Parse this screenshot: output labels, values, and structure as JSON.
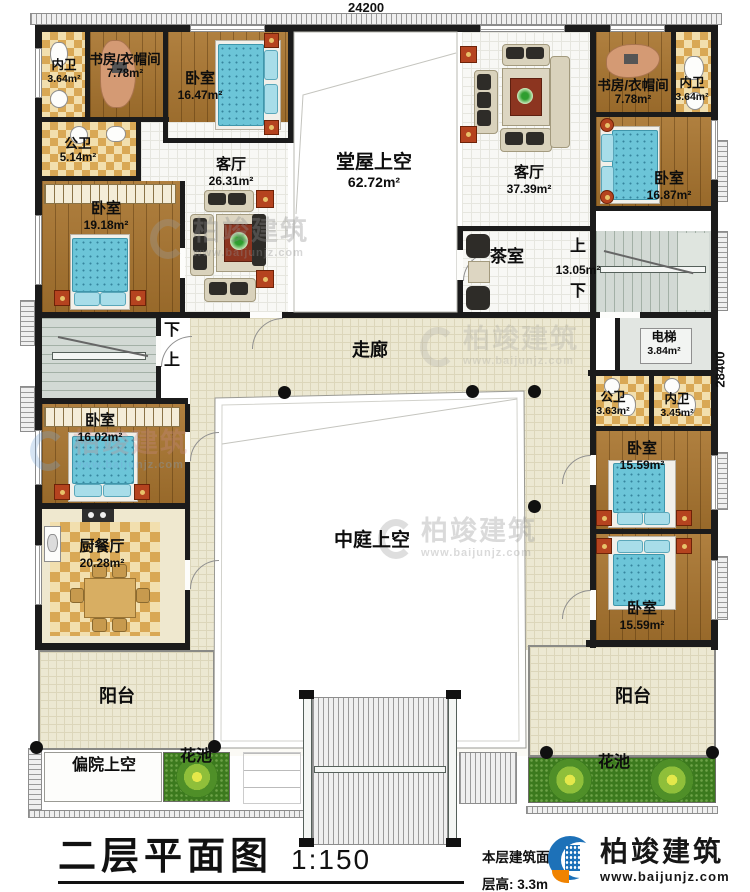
{
  "dimensions": {
    "top": "24200",
    "right": "28400"
  },
  "rooms": {
    "bath_tl": {
      "name": "内卫",
      "area": "3.64m²"
    },
    "study_tl": {
      "name": "书房/衣帽间",
      "area": "7.78m²"
    },
    "bed_tl": {
      "name": "卧室",
      "area": "16.47m²"
    },
    "pbath_tl": {
      "name": "公卫",
      "area": "5.14m²"
    },
    "living_l": {
      "name": "客厅",
      "area": "26.31m²"
    },
    "bed_l": {
      "name": "卧室",
      "area": "19.18m²"
    },
    "hall_void": {
      "name": "堂屋上空",
      "area": "62.72m²"
    },
    "living_r": {
      "name": "客厅",
      "area": "37.39m²"
    },
    "tea": {
      "name": "茶室"
    },
    "study_tr": {
      "name": "书房/衣帽间",
      "area": "7.78m²"
    },
    "bath_tr": {
      "name": "内卫",
      "area": "3.64m²"
    },
    "bed_tr": {
      "name": "卧室",
      "area": "16.87m²"
    },
    "stair_r": {
      "area": "13.05m²"
    },
    "elevator": {
      "name": "电梯",
      "area": "3.84m²"
    },
    "corridor": {
      "name": "走廊"
    },
    "pbath_r": {
      "name": "公卫",
      "area": "3.63m²"
    },
    "bath_r": {
      "name": "内卫",
      "area": "3.45m²"
    },
    "bed_r1": {
      "name": "卧室",
      "area": "15.59m²"
    },
    "bed_r2": {
      "name": "卧室",
      "area": "15.59m²"
    },
    "bed_bl": {
      "name": "卧室",
      "area": "16.02m²"
    },
    "kitchen": {
      "name": "厨餐厅",
      "area": "20.28m²"
    },
    "atrium_void": {
      "name": "中庭上空"
    },
    "balcony_l": {
      "name": "阳台"
    },
    "balcony_r": {
      "name": "阳台"
    },
    "court_void": {
      "name": "偏院上空"
    },
    "flower_l": {
      "name": "花池"
    },
    "flower_r": {
      "name": "花池"
    }
  },
  "stair_labels": {
    "up": "上",
    "down": "下"
  },
  "title_block": {
    "title": "二层平面图",
    "scale": "1:150",
    "area_label": "本层建筑面积",
    "floor_height": "层高: 3.3m"
  },
  "brand": {
    "name": "柏竣建筑",
    "url": "www.baijunjz.com"
  },
  "colors": {
    "wall": "#1b1b1b",
    "wood": "#a9752f",
    "tile_dark": "#d9a855",
    "tile_light": "#f2dfae",
    "bed": "#6cc5d8",
    "grass": "#3c7a1e",
    "corridor": "#ece8d2",
    "logo_blue": "#1d71b8",
    "logo_orange": "#f08300"
  }
}
